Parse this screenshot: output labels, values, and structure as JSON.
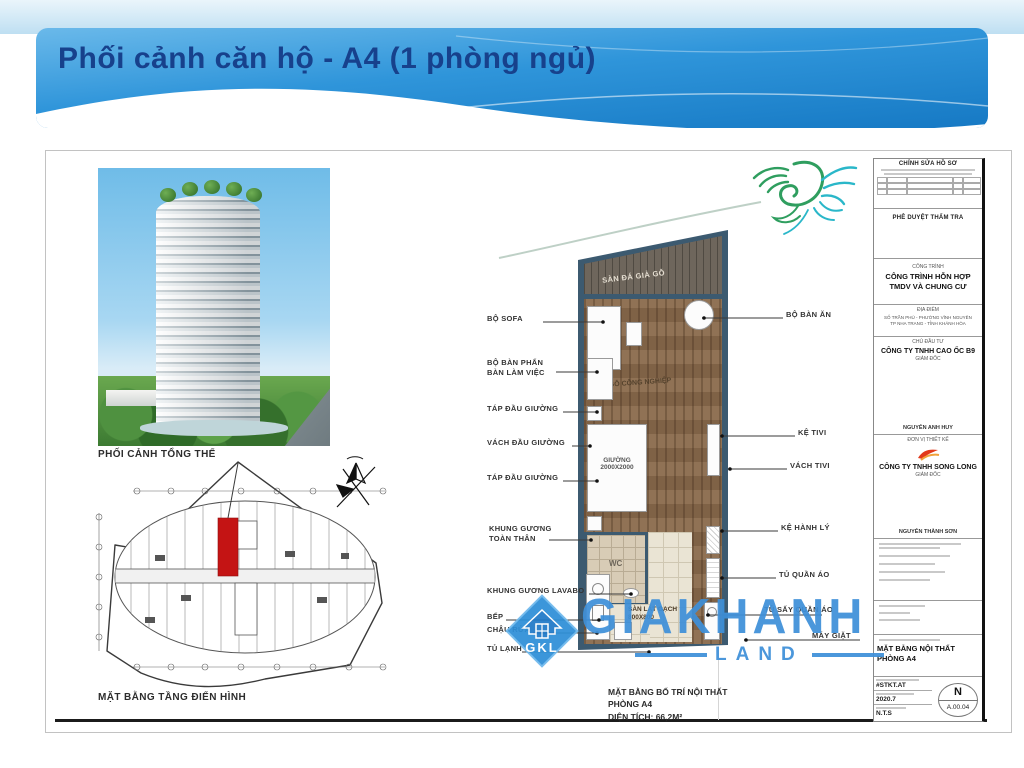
{
  "header": {
    "title": "Phối cảnh căn hộ - A4 (1 phòng ngủ)"
  },
  "captions": {
    "perspective": "PHỐI CẢNH TỔNG THỂ",
    "typical_floor": "MẶT BẰNG TẦNG ĐIỂN HÌNH",
    "unit_plan": "MẶT BẰNG BỐ TRÍ NỘI THẤT\nPHÒNG A4\nDIỆN TÍCH: 66,2M²"
  },
  "plan": {
    "room_labels": {
      "balcony": "SÀN ĐÁ GIẢ GỖ",
      "floor": "SÀN GỖ CÔNG NGHIỆP",
      "bed": "GIƯỜNG\n2000X2000",
      "wc": "WC",
      "entry": "SÀN LÁT GẠCH\n800X800"
    },
    "labels_left": [
      "BỘ SOFA",
      "BỘ BÀN PHẤN\nBÀN LÀM VIỆC",
      "TÁP ĐẦU GIƯỜNG",
      "VÁCH ĐẦU GIƯỜNG",
      "TÁP ĐẦU GIƯỜNG",
      "KHUNG GƯƠNG\nTOÀN THÂN",
      "KHUNG GƯƠNG LAVABO",
      "BẾP",
      "CHẬU RỬA",
      "TỦ LẠNH"
    ],
    "labels_right": [
      "BỘ BÀN ĂN",
      "KỆ TIVI",
      "VÁCH TIVI",
      "KỆ HÀNH LÝ",
      "TỦ QUẦN ÁO",
      "TỦ SẤY QUẦN ÁO",
      "MÁY GIẶT"
    ]
  },
  "titleblock": {
    "revision_header": "CHỈNH SỬA HỒ SƠ",
    "approval_header": "PHÊ DUYỆT THẨM TRA",
    "project_label": "CÔNG TRÌNH",
    "project_name": "CÔNG TRÌNH HỖN HỢP\nTMDV VÀ CHUNG CƯ",
    "location_label": "ĐỊA ĐIỂM",
    "location_value": "SỐ TRẦN PHÚ - PHƯỜNG VĨNH NGUYÊN\nTP NHA TRANG - TỈNH KHÁNH HÒA",
    "investor_label": "CHỦ ĐẦU TƯ",
    "investor_name": "CÔNG TY TNHH CAO ỐC B9",
    "investor_role": "GIÁM ĐỐC",
    "investor_signer": "NGUYỄN ANH HUY",
    "designer_label": "ĐƠN VỊ THIẾT KẾ",
    "designer_name": "CÔNG TY TNHH SONG LONG",
    "designer_role": "GIÁM ĐỐC",
    "designer_signer": "NGUYỄN THÀNH SƠN",
    "drawing_name": "MẶT BẰNG NỘI THẤT\nPHÒNG A4",
    "code1": "#STKT.AT",
    "code2": "2020.7",
    "scale": "N.T.S",
    "north": "N",
    "sheet_no": "A.00.04"
  },
  "watermark": {
    "brand": "GIAKHANH",
    "sub": "LAND",
    "logo_text": "GKL"
  },
  "colors": {
    "accent_blue": "#3e90d9",
    "banner_blue": "#1f87d2",
    "unit_red": "#c41414",
    "wall": "#3c5a70"
  }
}
